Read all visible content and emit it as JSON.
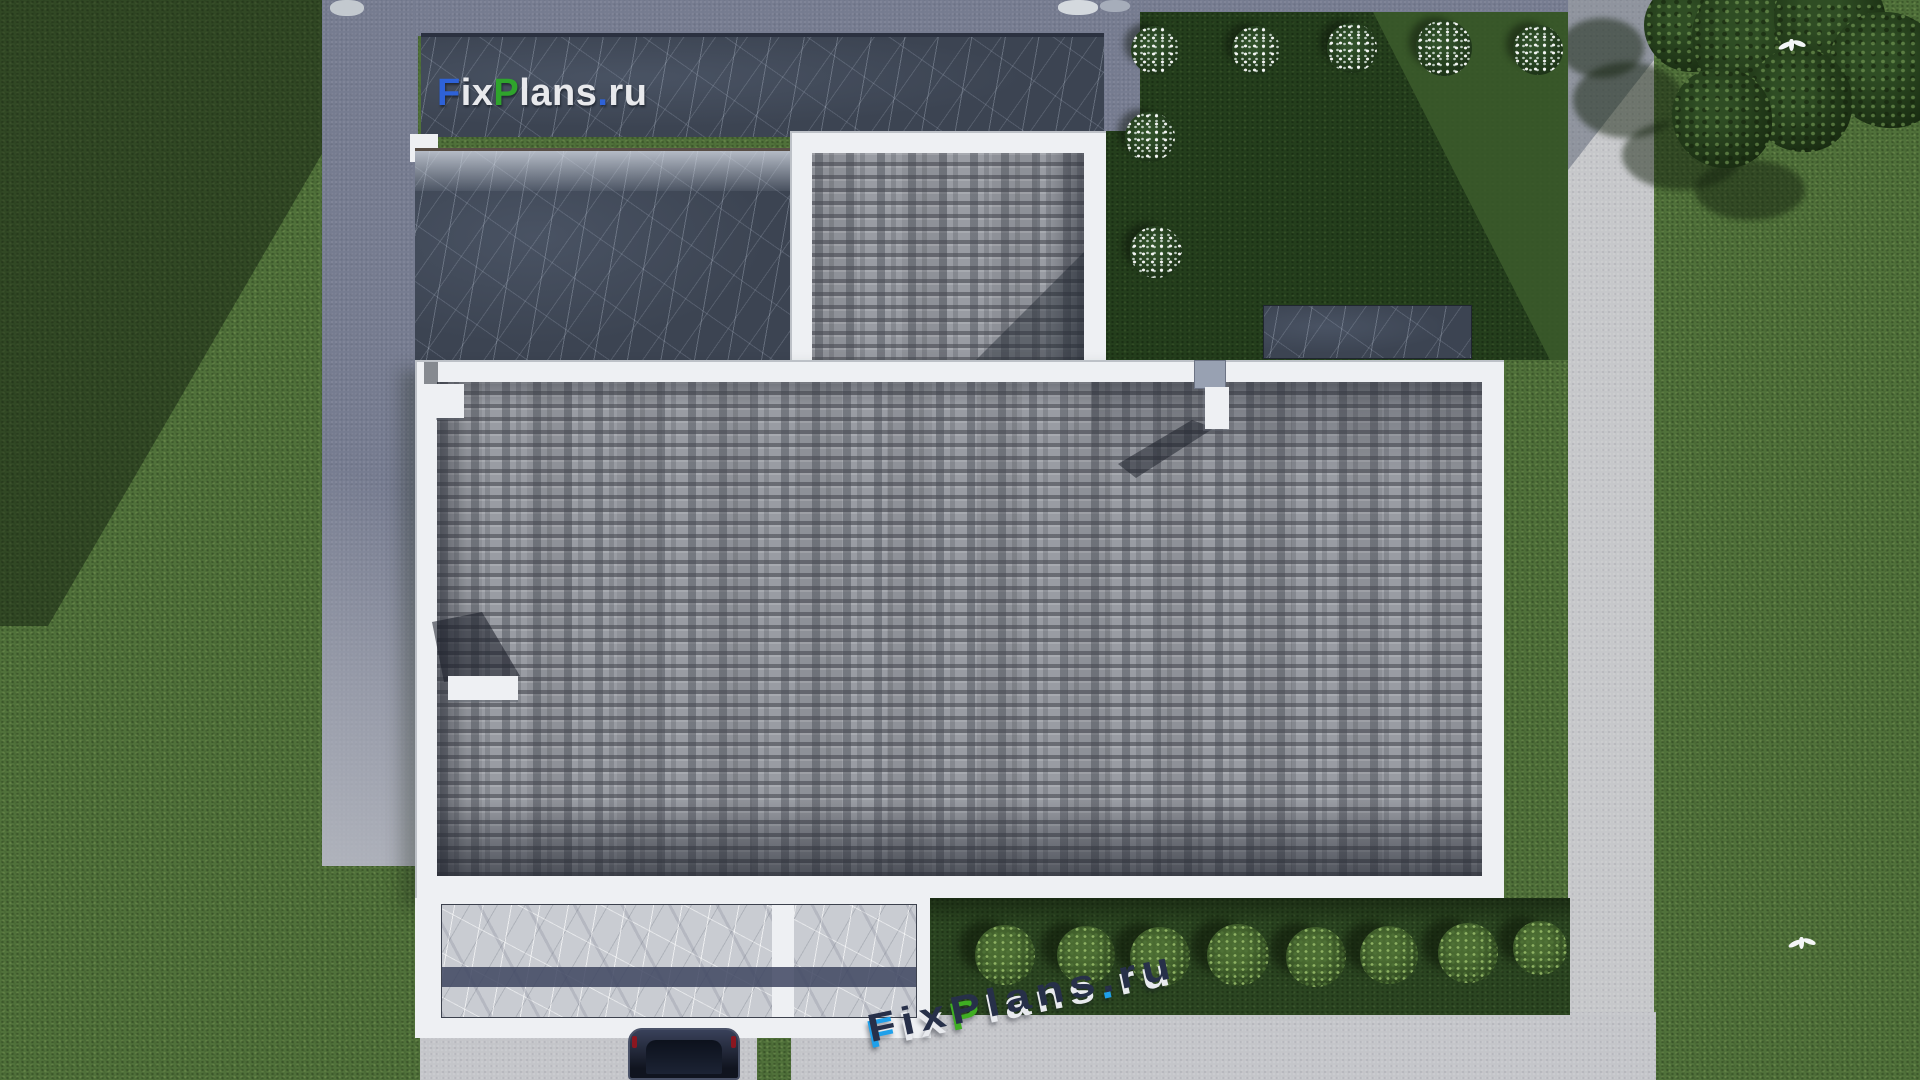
{
  "watermarks": {
    "logo_top": {
      "text": "FixPlans.ru",
      "letters": [
        {
          "ch": "F",
          "color": "#2e62d8"
        },
        {
          "ch": "i",
          "color": "#e8e9ec"
        },
        {
          "ch": "x",
          "color": "#e8e9ec"
        },
        {
          "ch": "P",
          "color": "#2fa42c"
        },
        {
          "ch": "l",
          "color": "#e8e9ec"
        },
        {
          "ch": "a",
          "color": "#e8e9ec"
        },
        {
          "ch": "n",
          "color": "#e8e9ec"
        },
        {
          "ch": "s",
          "color": "#e8e9ec"
        },
        {
          "ch": ".",
          "color": "#2e62d8"
        },
        {
          "ch": "r",
          "color": "#e8e9ec"
        },
        {
          "ch": "u",
          "color": "#e8e9ec"
        }
      ]
    },
    "logo_ground": {
      "text": "FixPlans.ru",
      "letters": [
        {
          "ch": "F",
          "front": "#1fa0ea"
        },
        {
          "ch": "i",
          "front": "#e8eaee"
        },
        {
          "ch": "x",
          "front": "#e8eaee"
        },
        {
          "ch": "P",
          "front": "#3fae22"
        },
        {
          "ch": "l",
          "front": "#e8eaee"
        },
        {
          "ch": "a",
          "front": "#e8eaee"
        },
        {
          "ch": "n",
          "front": "#e8eaee"
        },
        {
          "ch": "s",
          "front": "#e8eaee"
        },
        {
          "ch": ".",
          "front": "#1fa0ea"
        },
        {
          "ch": "r",
          "front": "#e8eaee"
        },
        {
          "ch": "u",
          "front": "#e8eaee"
        }
      ]
    }
  },
  "palette": {
    "grass-sun": "#50713a",
    "grass-shade": "#2c4722",
    "courtyard": "#243e1c",
    "courtyard-lit": "#3c5c2b",
    "hedge-strip": "#2b4521",
    "concrete": "#767c90",
    "concrete-lit": "#b0b3bc",
    "road": "#c6c7ca",
    "pavement": "#c4c5c9",
    "parapet": "#eef0f3",
    "shingle": "#999ca3",
    "shingle-dark": "#4a4e5a",
    "marble-dark": "#3c4452",
    "marble-light": "#c9ccd2",
    "terrace-stripe": "#3e4560",
    "car-body": "#1c2230",
    "bush-green": "#4a6b31",
    "tree-green": "#2f4d24",
    "letter-top": "#273049"
  },
  "scene": {
    "courtyard_bushes": [
      {
        "x": 1155,
        "y": 50,
        "r": 24
      },
      {
        "x": 1256,
        "y": 50,
        "r": 24
      },
      {
        "x": 1352,
        "y": 48,
        "r": 25
      },
      {
        "x": 1444,
        "y": 48,
        "r": 28
      },
      {
        "x": 1538,
        "y": 50,
        "r": 25
      },
      {
        "x": 1150,
        "y": 137,
        "r": 25
      },
      {
        "x": 1156,
        "y": 252,
        "r": 26
      }
    ],
    "hedge_bushes": [
      {
        "x": 1005,
        "y": 955,
        "r": 30
      },
      {
        "x": 1086,
        "y": 955,
        "r": 29
      },
      {
        "x": 1160,
        "y": 957,
        "r": 30
      },
      {
        "x": 1238,
        "y": 955,
        "r": 31
      },
      {
        "x": 1316,
        "y": 957,
        "r": 30
      },
      {
        "x": 1389,
        "y": 955,
        "r": 29
      },
      {
        "x": 1468,
        "y": 953,
        "r": 30
      },
      {
        "x": 1540,
        "y": 948,
        "r": 27
      }
    ],
    "trees": [
      {
        "x": 1688,
        "y": 28,
        "r": 44
      },
      {
        "x": 1752,
        "y": 40,
        "r": 60
      },
      {
        "x": 1830,
        "y": 22,
        "r": 56
      },
      {
        "x": 1886,
        "y": 70,
        "r": 58
      },
      {
        "x": 1800,
        "y": 100,
        "r": 52
      },
      {
        "x": 1722,
        "y": 118,
        "r": 50
      }
    ],
    "tree_shadows": [
      {
        "x": 1602,
        "y": 48,
        "rx": 42,
        "ry": 30
      },
      {
        "x": 1628,
        "y": 100,
        "rx": 55,
        "ry": 38
      },
      {
        "x": 1682,
        "y": 155,
        "rx": 60,
        "ry": 35
      },
      {
        "x": 1750,
        "y": 190,
        "rx": 55,
        "ry": 30
      }
    ],
    "birds": [
      {
        "x": 1778,
        "y": 36
      },
      {
        "x": 1788,
        "y": 934
      }
    ],
    "deco_blobs": [
      {
        "x": 1058,
        "y": 0,
        "w": 40,
        "h": 15,
        "c": "#d4d9de"
      },
      {
        "x": 1100,
        "y": 0,
        "w": 30,
        "h": 12,
        "c": "#a6adba"
      },
      {
        "x": 330,
        "y": 0,
        "w": 34,
        "h": 16,
        "c": "#c3c9cf"
      }
    ]
  }
}
